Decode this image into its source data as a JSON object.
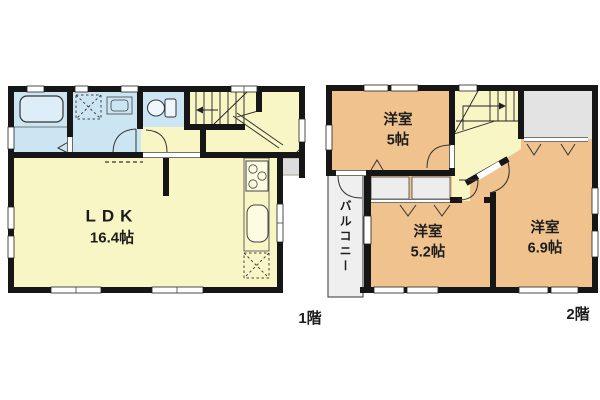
{
  "floors": [
    {
      "label": "1階",
      "rooms": [
        {
          "type": "ldk",
          "line1": "LDK",
          "line2": "16.4帖"
        }
      ]
    },
    {
      "label": "2階",
      "rooms": [
        {
          "type": "western-room",
          "line1": "洋室",
          "line2": "5帖"
        },
        {
          "type": "western-room",
          "line1": "洋室",
          "line2": "5.2帖"
        },
        {
          "type": "western-room",
          "line1": "洋室",
          "line2": "6.9帖"
        }
      ],
      "balcony": "バルコニー"
    }
  ],
  "colors": {
    "wall": "#161616",
    "room_yellow": "#f8f6c5",
    "water_blue": "#cbe5f2",
    "room_orange": "#f0c28d",
    "closet_gray": "#e3e3e3",
    "balcony_gray": "#efefef"
  }
}
